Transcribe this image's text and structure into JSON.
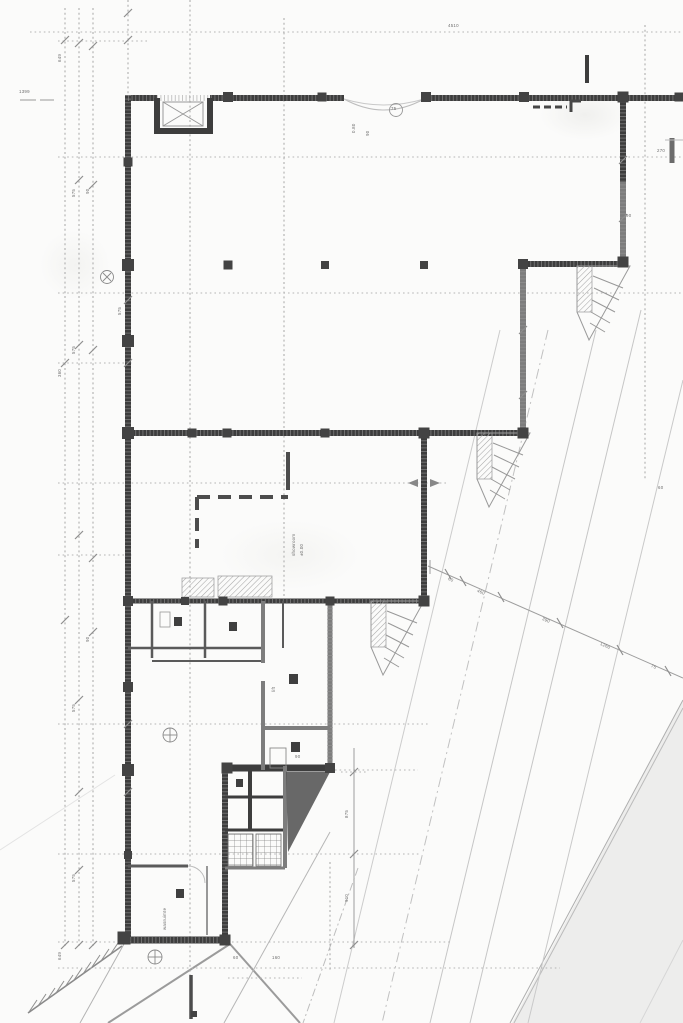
{
  "drawing": {
    "kind": "scanned architectural floor plan, ground level",
    "paper_color": "#fbfbfa",
    "colors": {
      "wall_dark": "#3a3a3a",
      "wall_medium": "#7d7d7d",
      "partition": "#585858",
      "grid_line": "#b6b6b6",
      "dimension_line": "#9e9e9e",
      "annotation_text": "#6e6e6e",
      "road_shade": "#f2f2f1",
      "ramp_triangle": "#525252"
    },
    "symbols": [
      "hatched-exterior-walls",
      "elevator-shaft-x-symbol",
      "column-blobs",
      "exterior-stair-wedges",
      "grid-bubbles",
      "dimension-tick-marks",
      "diagonal-site-lines",
      "hatched-boundary-line"
    ]
  },
  "ann": {
    "topleft": "1399",
    "top_dim": "4510",
    "dim270": "270",
    "stack080": "0.80",
    "stack90": "90",
    "circ75": "75",
    "dim90a": "90",
    "showroom": "showroom",
    "level": "±0.00",
    "lift": "lift",
    "dim90b": "90",
    "wash": "wasruimte",
    "rd60": "60",
    "rd460": "460",
    "rd390": "390",
    "rd1260": "1260",
    "rd75": "75",
    "vd875": "875",
    "vd910": "910",
    "ch649a": "649",
    "ch575a": "575",
    "ch90a": "90",
    "ch360a": "360",
    "ch575b": "575",
    "ch90b": "90",
    "ch575c": "575",
    "ch575d": "575",
    "ch649b": "649",
    "walldim": "575",
    "b60": "60",
    "b160": "160",
    "r60": "60"
  }
}
